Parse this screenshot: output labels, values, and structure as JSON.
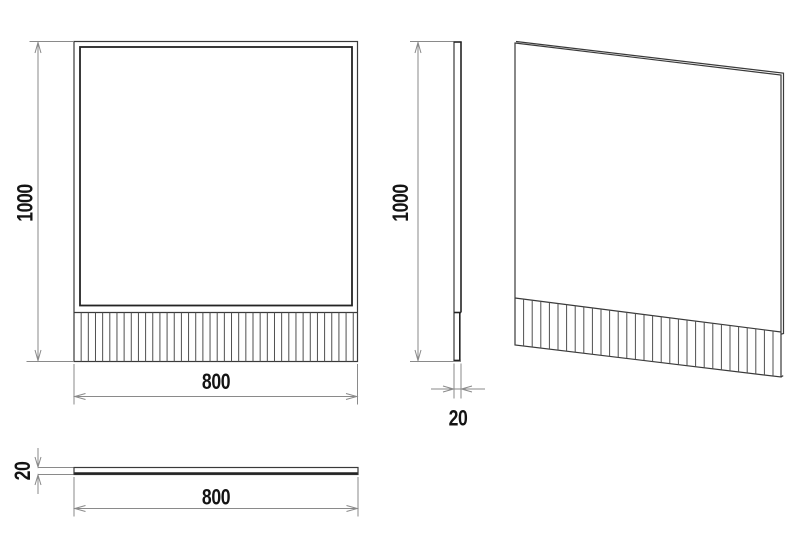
{
  "views": {
    "front": {
      "height_label": "1000",
      "width_label": "800"
    },
    "side": {
      "height_label": "1000",
      "thickness_label": "20"
    },
    "top": {
      "thickness_label": "20",
      "width_label": "800"
    },
    "perspective": {}
  },
  "colors": {
    "background": "#ffffff",
    "object_line": "#3a3a3a",
    "object_dark": "#242424",
    "dimension_line": "#8a8a8a",
    "text": "#141414"
  }
}
